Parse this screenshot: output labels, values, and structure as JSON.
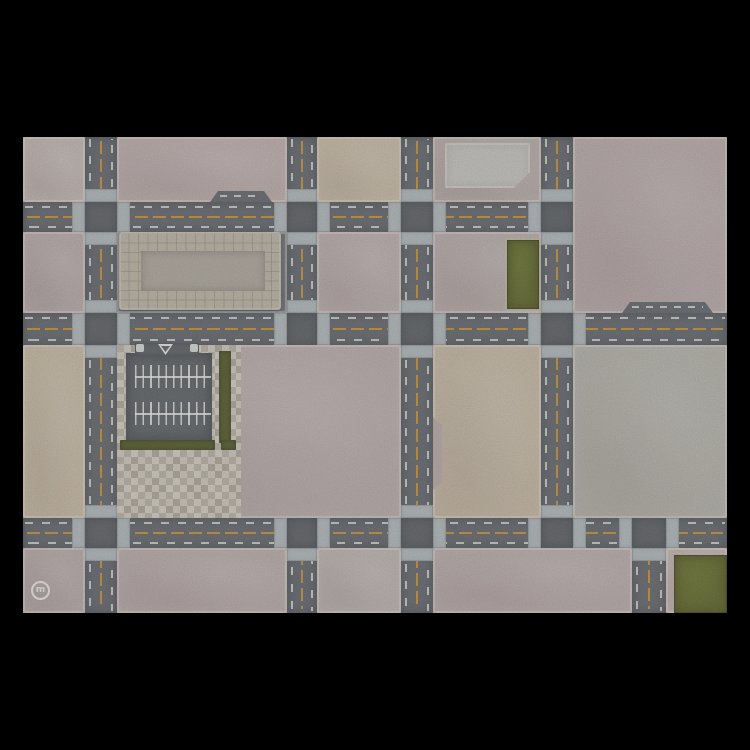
{
  "canvas": {
    "width": 750,
    "height": 750,
    "background": "#000000"
  },
  "mat": {
    "x": 23,
    "y": 137,
    "w": 704,
    "h": 476,
    "base_color": "#b3a7a5"
  },
  "palette": {
    "road": "#5b6066",
    "intersection": "#54595e",
    "crosswalk": "#aeb7ba",
    "yellow_line": "#c18c33",
    "white_dash": "rgba(236,240,234,0.72)",
    "grass": "#57601f",
    "hedge": "#4a5220",
    "parking_asphalt": "#565b5f",
    "plaza_base": "#b5aea2",
    "tilepad_base": "#b9b1a2",
    "tilepad_inner": "#a9a399",
    "raised_pad": "#c3c2be",
    "curb_white": "#e2e6e1",
    "logo_white": "rgba(248,248,244,0.82)"
  },
  "blocks": [
    {
      "id": "a1",
      "x": 0,
      "y": 0,
      "w": 62,
      "h": 65,
      "color": "#bdb2ae"
    },
    {
      "id": "a2",
      "x": 94,
      "y": 0,
      "w": 170,
      "h": 65,
      "color": "#b9aaa9"
    },
    {
      "id": "a3",
      "x": 294,
      "y": 0,
      "w": 84,
      "h": 65,
      "color": "#c4b7a1"
    },
    {
      "id": "a4",
      "x": 410,
      "y": 0,
      "w": 108,
      "h": 65,
      "color": "#b2a7a5"
    },
    {
      "id": "a5",
      "x": 550,
      "y": 0,
      "w": 154,
      "h": 176,
      "color": "#b5a7a7"
    },
    {
      "id": "b1",
      "x": 0,
      "y": 95,
      "w": 62,
      "h": 81,
      "color": "#b2a5a5"
    },
    {
      "id": "b2",
      "x": 94,
      "y": 95,
      "w": 170,
      "h": 81,
      "color": "#5f646a"
    },
    {
      "id": "b3",
      "x": 294,
      "y": 95,
      "w": 84,
      "h": 81,
      "color": "#b6a9a9"
    },
    {
      "id": "b4",
      "x": 410,
      "y": 95,
      "w": 108,
      "h": 81,
      "color": "#b3a8a6"
    },
    {
      "id": "m1",
      "x": 0,
      "y": 208,
      "w": 62,
      "h": 173,
      "color": "#c3b69f"
    },
    {
      "id": "m2",
      "x": 94,
      "y": 208,
      "w": 284,
      "h": 173,
      "color": "#b5a8a8"
    },
    {
      "id": "m4",
      "x": 410,
      "y": 208,
      "w": 108,
      "h": 173,
      "color": "#c2b59f",
      "clip": "polygon(0 0, 100% 0, 100% 100%, 0 100%, 0 145px, 9px 137px, 9px 80px, 0 72px)"
    },
    {
      "id": "m5",
      "x": 550,
      "y": 208,
      "w": 154,
      "h": 173,
      "color": "#b0aea6"
    },
    {
      "id": "c1",
      "x": 0,
      "y": 411,
      "w": 62,
      "h": 65,
      "color": "#b1a4a4"
    },
    {
      "id": "c2",
      "x": 94,
      "y": 411,
      "w": 170,
      "h": 65,
      "color": "#b4a7a6"
    },
    {
      "id": "c3",
      "x": 294,
      "y": 411,
      "w": 84,
      "h": 65,
      "color": "#b8afac"
    },
    {
      "id": "c4",
      "x": 410,
      "y": 411,
      "w": 199,
      "h": 65,
      "color": "#b5a8a7"
    },
    {
      "id": "c5",
      "x": 643,
      "y": 411,
      "w": 61,
      "h": 65,
      "color": "#c0b1ad"
    }
  ],
  "roads": {
    "horizontal": [
      {
        "id": "h-top",
        "x": 0,
        "y": 65,
        "w": 550,
        "h": 30
      },
      {
        "id": "h-mid",
        "x": 0,
        "y": 176,
        "w": 704,
        "h": 32
      },
      {
        "id": "h-bottom",
        "x": 0,
        "y": 381,
        "w": 704,
        "h": 30
      }
    ],
    "vertical": [
      {
        "id": "v1",
        "x": 62,
        "y": 0,
        "w": 32,
        "h": 476
      },
      {
        "id": "v2-upper",
        "x": 264,
        "y": 0,
        "w": 30,
        "h": 208
      },
      {
        "id": "v2-lower",
        "x": 264,
        "y": 411,
        "w": 30,
        "h": 65
      },
      {
        "id": "v3",
        "x": 378,
        "y": 0,
        "w": 32,
        "h": 476
      },
      {
        "id": "v4",
        "x": 518,
        "y": 0,
        "w": 32,
        "h": 411
      },
      {
        "id": "v5",
        "x": 609,
        "y": 411,
        "w": 34,
        "h": 65
      }
    ]
  },
  "intersections": [
    {
      "x": 62,
      "y": 65,
      "w": 32,
      "h": 30,
      "approaches": "nsew"
    },
    {
      "x": 264,
      "y": 65,
      "w": 30,
      "h": 30,
      "approaches": "nsew"
    },
    {
      "x": 378,
      "y": 65,
      "w": 32,
      "h": 30,
      "approaches": "nsew"
    },
    {
      "x": 518,
      "y": 65,
      "w": 32,
      "h": 30,
      "approaches": "nsw"
    },
    {
      "x": 62,
      "y": 176,
      "w": 32,
      "h": 32,
      "approaches": "nsew"
    },
    {
      "x": 264,
      "y": 176,
      "w": 30,
      "h": 32,
      "approaches": "new"
    },
    {
      "x": 378,
      "y": 176,
      "w": 32,
      "h": 32,
      "approaches": "nsew"
    },
    {
      "x": 518,
      "y": 176,
      "w": 32,
      "h": 32,
      "approaches": "nsew"
    },
    {
      "x": 62,
      "y": 381,
      "w": 32,
      "h": 30,
      "approaches": "nsew"
    },
    {
      "x": 264,
      "y": 381,
      "w": 30,
      "h": 30,
      "approaches": "sew"
    },
    {
      "x": 378,
      "y": 381,
      "w": 32,
      "h": 30,
      "approaches": "nsew"
    },
    {
      "x": 518,
      "y": 381,
      "w": 32,
      "h": 30,
      "approaches": "new"
    },
    {
      "x": 609,
      "y": 381,
      "w": 34,
      "h": 30,
      "approaches": "sew"
    }
  ],
  "crosswalk_width": 13,
  "bumps": [
    {
      "x": 187,
      "y": 54,
      "w": 62,
      "h": 11
    },
    {
      "x": 599,
      "y": 165,
      "w": 91,
      "h": 11
    }
  ],
  "pads": {
    "raised_pad": {
      "x": 422,
      "y": 6,
      "w": 85,
      "h": 45,
      "clip": "polygon(0 0, 100% 0, 100% calc(100% - 16px), calc(100% - 16px) 100%, 0 100%)"
    },
    "tile_pad": {
      "x": 96,
      "y": 95,
      "w": 162,
      "h": 78,
      "inner": {
        "x": 22,
        "y": 19,
        "w": 124,
        "h": 40
      }
    }
  },
  "plaza": {
    "x": 94,
    "y": 208,
    "w": 124,
    "h": 173
  },
  "parking": {
    "asphalt": {
      "x": 103,
      "y": 216,
      "w": 86,
      "h": 88
    },
    "combs": [
      {
        "x": 112,
        "y": 228,
        "w": 76,
        "h": 23,
        "line_offset": 11
      },
      {
        "x": 112,
        "y": 265,
        "w": 76,
        "h": 23,
        "line_offset": 11
      }
    ],
    "hedges": [
      {
        "x": 196,
        "y": 214,
        "w": 12,
        "h": 92
      },
      {
        "x": 97,
        "y": 303,
        "w": 95,
        "h": 10
      },
      {
        "x": 198,
        "y": 303,
        "w": 15,
        "h": 10
      }
    ],
    "entrance": {
      "asphalt": {
        "x": 112,
        "y": 206,
        "w": 64,
        "h": 13
      },
      "curbs": [
        {
          "x": 113,
          "y": 207,
          "w": 8,
          "h": 8
        },
        {
          "x": 167,
          "y": 207,
          "w": 8,
          "h": 8
        }
      ],
      "triangle": {
        "x": 135,
        "y": 207,
        "w": 15,
        "h": 11
      }
    }
  },
  "grass_patches": [
    {
      "id": "grass-courtyard",
      "x": 482,
      "y": 101,
      "w": 32,
      "h": 69,
      "frame": true
    },
    {
      "id": "grass-corner",
      "x": 651,
      "y": 418,
      "w": 53,
      "h": 58,
      "frame": false
    }
  ],
  "logo": {
    "x": 8,
    "y": 444,
    "size": 19,
    "letter": "m"
  }
}
